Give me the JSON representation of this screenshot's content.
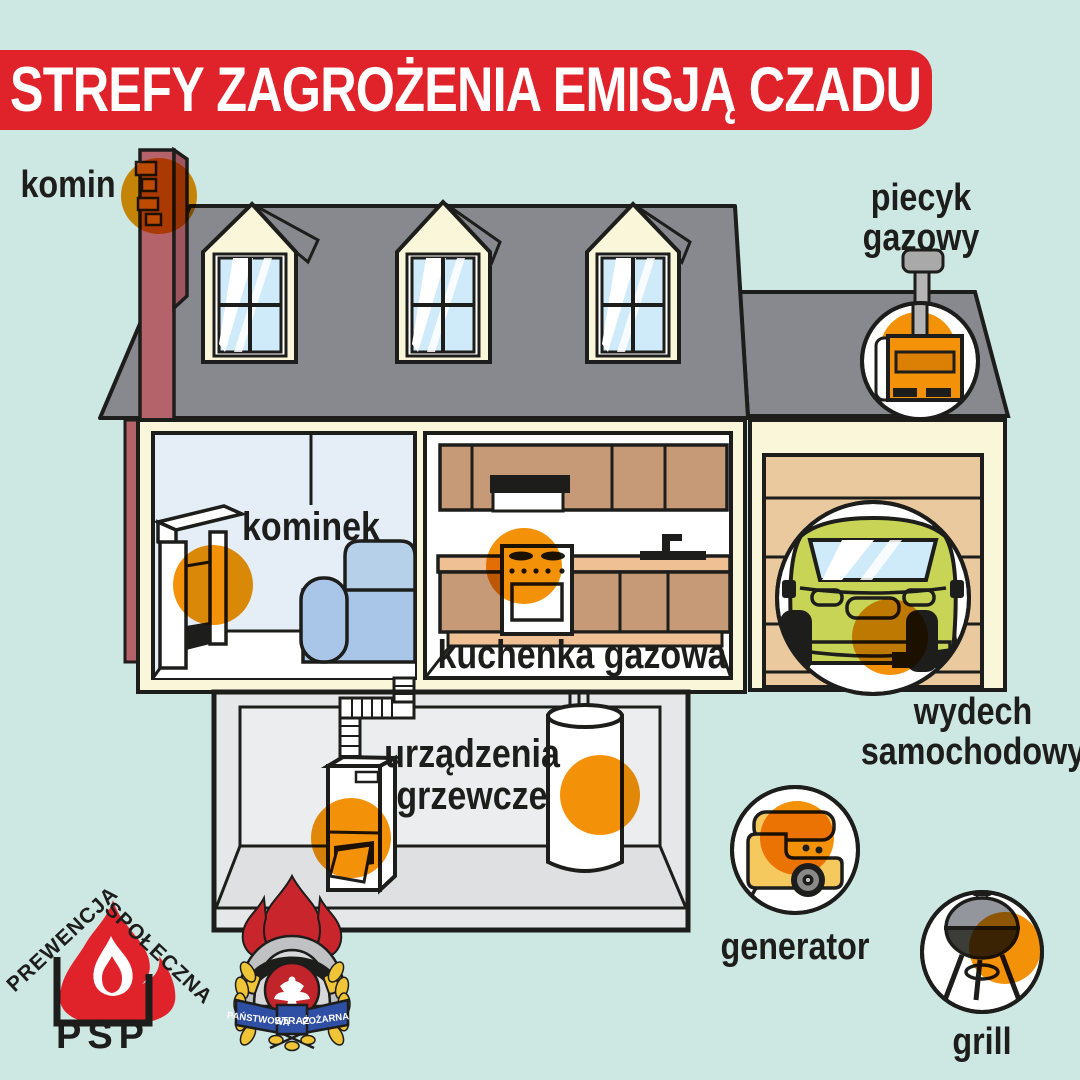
{
  "title": "STREFY ZAGROŻENIA EMISJĄ CZADU",
  "labels": {
    "komin": "komin",
    "piecyk_gazowy": "piecyk\ngazowy",
    "kominek": "kominek",
    "kuchenka_gazowa": "kuchenka gazowa",
    "urzadzenia_grzewcze": "urządzenia\ngrzewcze",
    "wydech_samochodowy": "wydech\nsamochodowy",
    "generator": "generator",
    "grill": "grill"
  },
  "logos": {
    "psp": {
      "arc_left": "PREWENCJA",
      "arc_right": "SPOŁECZNA",
      "abbr": "PSP"
    },
    "badge": {
      "ribbon_left": "PAŃSTWOWA",
      "ribbon_center": "STRAŻ",
      "ribbon_right": "POŻARNA"
    }
  },
  "colors": {
    "background": "#cde7e3",
    "banner_red": "#e0232b",
    "hazard_orange": "#f39208",
    "roof_gray": "#87898e",
    "wall_cream": "#faf6d9",
    "chimney_red": "#b4636b",
    "chimney_side": "#9d5660",
    "brick_orange": "#c8823f",
    "glass_blue": "#cfeaf8",
    "room_blue": "#e5eef7",
    "sofa_blue": "#a9c6e8",
    "cabinet_tan": "#c69a76",
    "counter_tan": "#eec094",
    "garage_door_tan": "#e9c99d",
    "car_green": "#c8d455",
    "basement_gray": "#e6e7e8",
    "generator_yellow": "#f6c95e",
    "pipe_gray": "#b5b5b5",
    "badge_red": "#c9252c",
    "badge_blue": "#2e4fa3",
    "laurel_yellow": "#f0c437",
    "helmet_gray": "#bfc1c3",
    "outline_black": "#1d1d1b"
  }
}
